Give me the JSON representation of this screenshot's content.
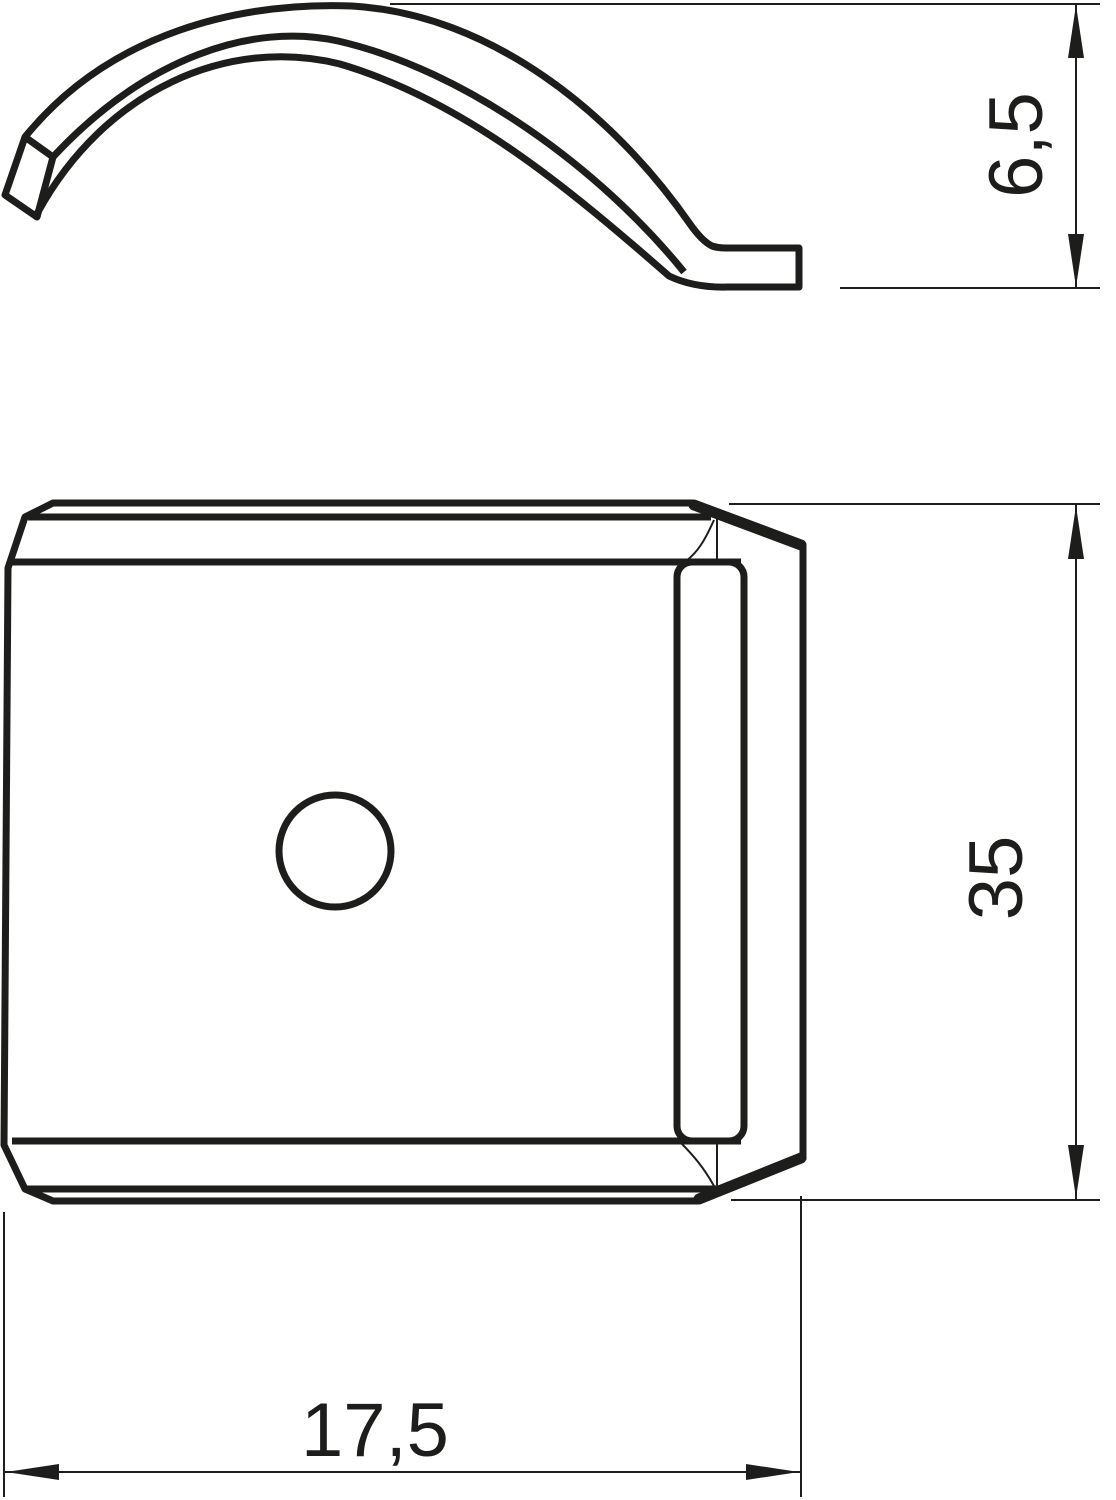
{
  "drawing": {
    "type": "technical-dimension-drawing",
    "background_color": "#ffffff",
    "line_color": "#1d1d1b",
    "views": [
      {
        "id": "side-profile-view",
        "description": "curved spring clip profile with flat foot, side view"
      },
      {
        "id": "front-view",
        "description": "clip plate front view with chamfered corners, side tab band and central round hole"
      }
    ],
    "dimensions": [
      {
        "id": "clip-height",
        "label": "6,5",
        "orientation": "vertical-rotated"
      },
      {
        "id": "plate-length",
        "label": "35",
        "orientation": "vertical-rotated"
      },
      {
        "id": "plate-width",
        "label": "17,5",
        "orientation": "horizontal"
      }
    ]
  }
}
